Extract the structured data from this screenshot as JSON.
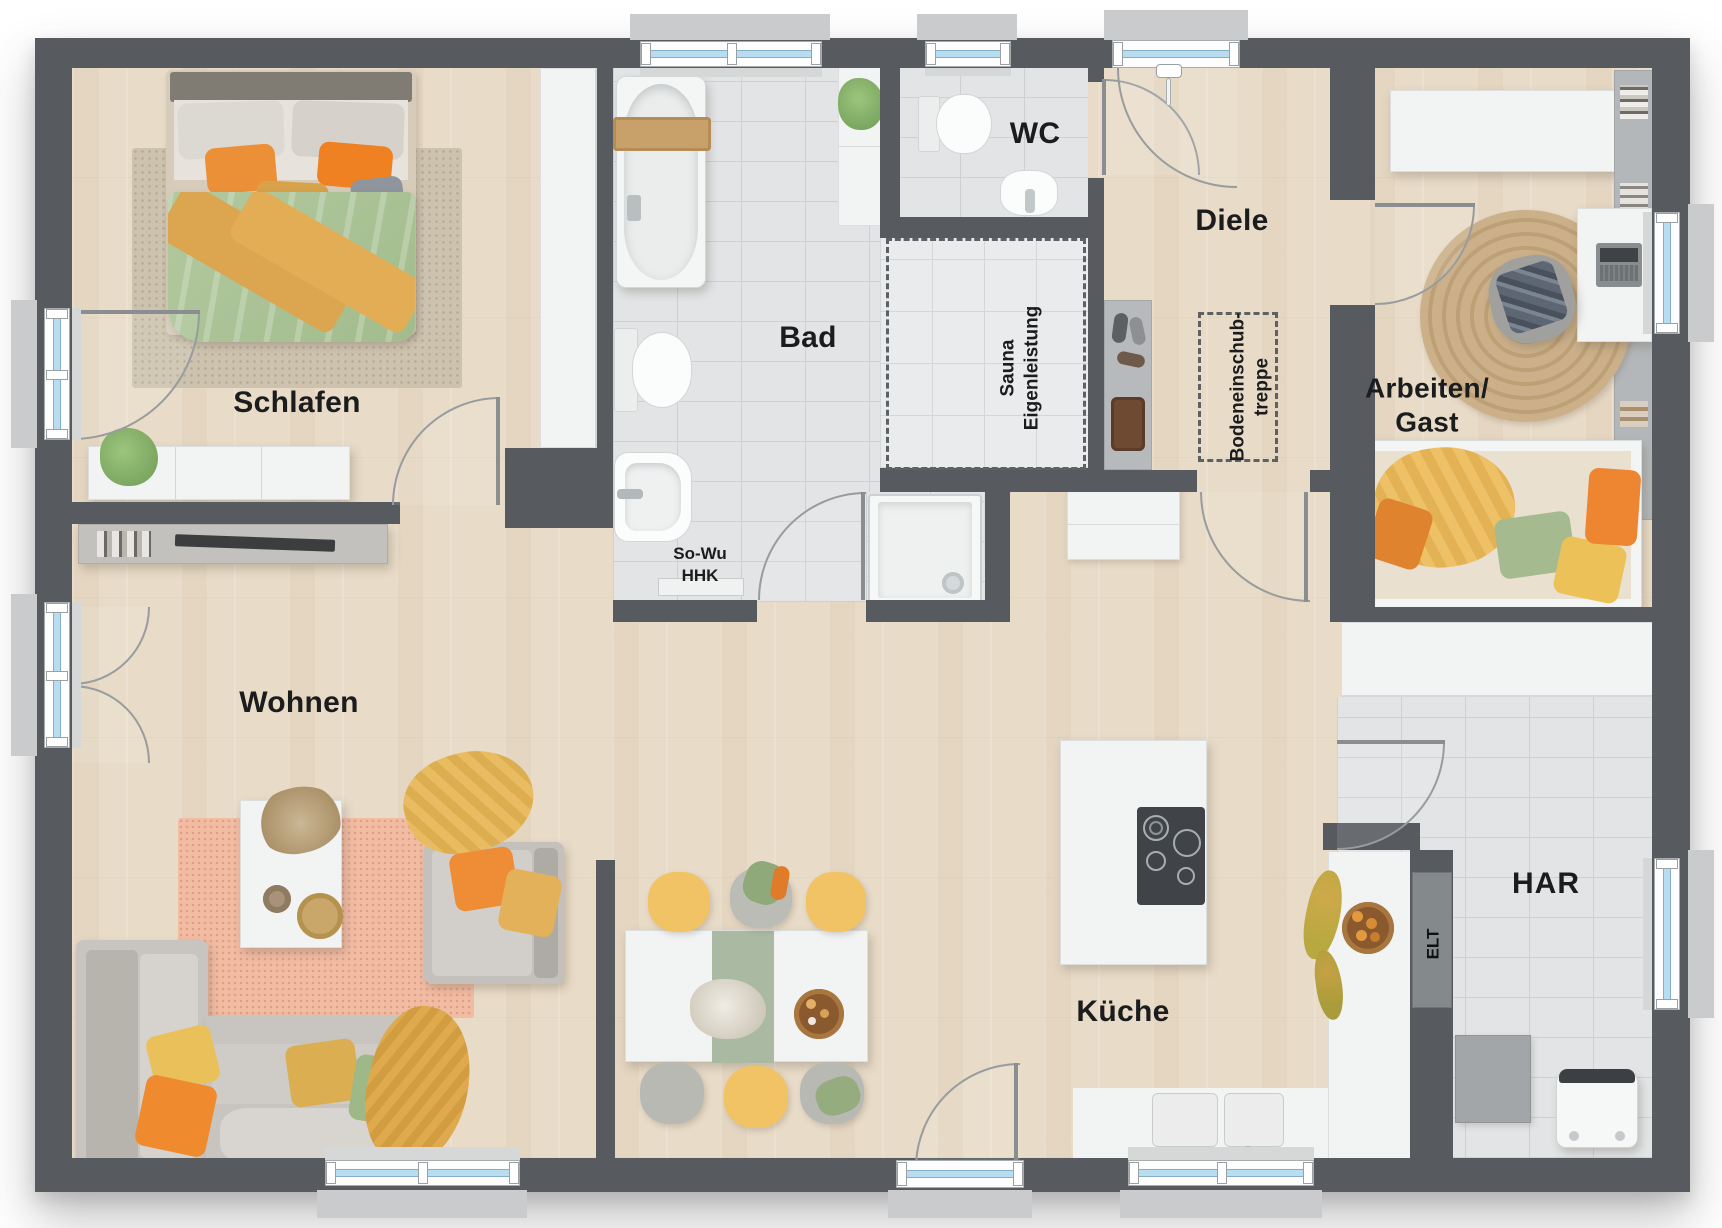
{
  "title": "Bungalow Grundriss",
  "rooms": {
    "schlafen": {
      "label": "Schlafen"
    },
    "bad": {
      "label": "Bad"
    },
    "wc": {
      "label": "WC"
    },
    "diele": {
      "label": "Diele"
    },
    "arbeiten_gast": {
      "line1": "Arbeiten/",
      "line2": "Gast"
    },
    "wohnen": {
      "label": "Wohnen"
    },
    "kueche": {
      "label": "Küche"
    },
    "har": {
      "label": "HAR"
    }
  },
  "annotations": {
    "heizung": {
      "line1": "So-Wu",
      "line2": "HHK"
    },
    "sauna": {
      "line1": "Sauna",
      "line2": "Eigenleistung"
    },
    "bodentreppe": {
      "line1": "Bodeneinschub-",
      "line2": "treppe"
    },
    "elt": {
      "label": "ELT"
    }
  },
  "colors": {
    "wall": "#575b5f",
    "window_glass": "#b8ddf1",
    "wood_floor": "#e8dbc7",
    "tile_floor": "#e2e4e6",
    "accent_orange": "#ee8a33",
    "accent_mustard": "#dba64f",
    "accent_green": "#a7bf92",
    "rug_pink": "#f2bca3",
    "rug_jute": "#c7ab80"
  }
}
